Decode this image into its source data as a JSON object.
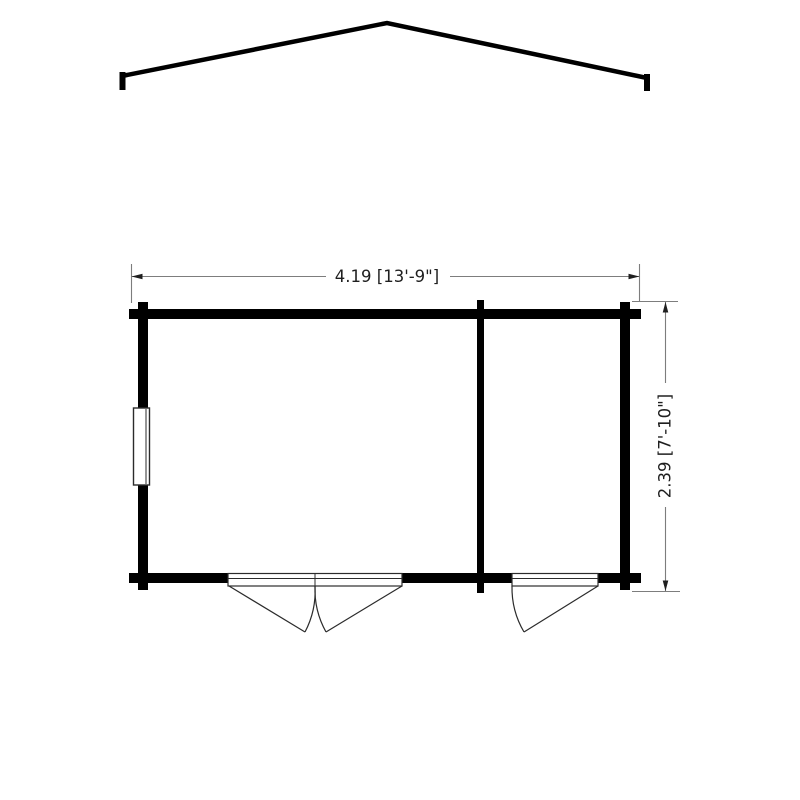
{
  "floor_plan": {
    "width_dimension_label": "4.19 [13'-9\"]",
    "depth_dimension_label": "2.39 [7'-10\"]"
  },
  "colors": {
    "wall": "#000000",
    "roof": "#000000",
    "door_outline": "#2b2b2b",
    "dimension_line": "#7d7d7d",
    "arrow": "#1f1f1f",
    "text": "#1f1f1f",
    "background": "#ffffff"
  }
}
